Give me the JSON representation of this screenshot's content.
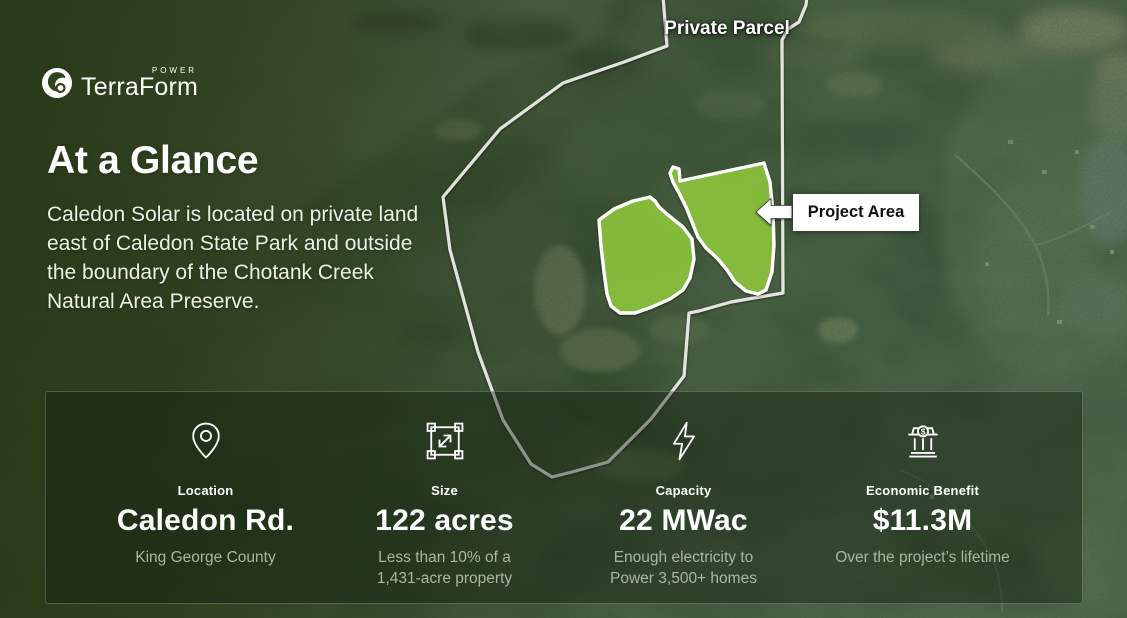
{
  "brand": {
    "name": "TerraForm",
    "superscript": "POWER"
  },
  "hero": {
    "title": "At a Glance",
    "description": "Caledon Solar is located on private land east of Caledon State Park and outside the boundary of the Chotank Creek Natural Area Preserve."
  },
  "map": {
    "private_parcel_label": "Private Parcel",
    "project_area_label": "Project Area",
    "project_area_fill": "#8dc63f",
    "boundary_color": "#eff2ec"
  },
  "stats": [
    {
      "icon": "location-pin-icon",
      "label": "Location",
      "value": "Caledon Rd.",
      "subtext": "King George County"
    },
    {
      "icon": "area-size-icon",
      "label": "Size",
      "value": "122 acres",
      "subtext": "Less than 10% of a 1,431-acre property"
    },
    {
      "icon": "lightning-bolt-icon",
      "label": "Capacity",
      "value": "22 MWac",
      "subtext": "Enough electricity to Power 3,500+ homes"
    },
    {
      "icon": "bank-icon",
      "label": "Economic Benefit",
      "value": "$11.3M",
      "subtext": "Over the project’s lifetime"
    }
  ]
}
